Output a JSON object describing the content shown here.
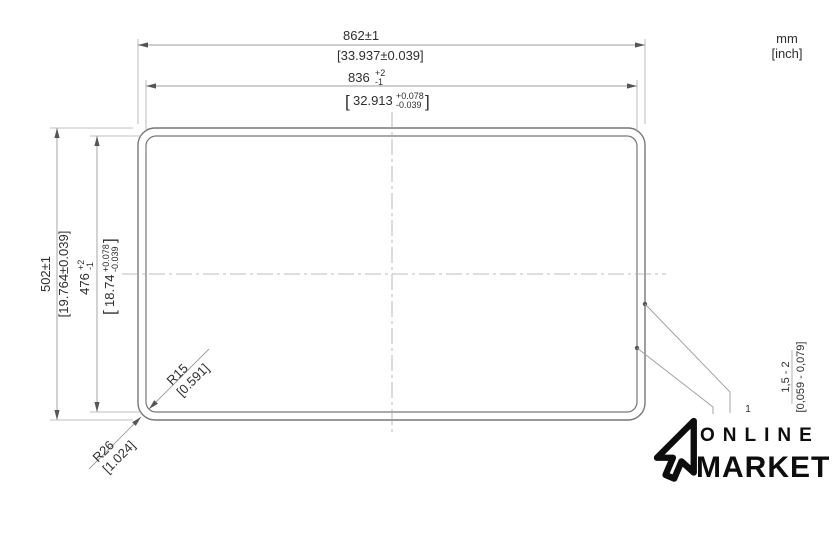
{
  "units": {
    "metric": "mm",
    "imperial": "[inch]"
  },
  "dims": {
    "width_outer": {
      "label": "862±1",
      "inch": "[33.937±0.039]"
    },
    "width_inner": {
      "value": "836",
      "tol_plus": "+2",
      "tol_minus": "-1",
      "inch_open": "[",
      "inch_value": "32.913",
      "inch_tol_plus": "+0.078",
      "inch_tol_minus": "-0.039",
      "inch_close": "]"
    },
    "height_outer": {
      "label": "502±1",
      "inch": "[19.764±0.039]"
    },
    "height_inner": {
      "value": "476",
      "tol_plus": "+2",
      "tol_minus": "-1",
      "inch_open": "[",
      "inch_value": "18.74",
      "inch_tol_plus": "+0.078",
      "inch_tol_minus": "-0.039",
      "inch_close": "]"
    },
    "radius_inner": {
      "label": "R15",
      "inch": "[0.591]"
    },
    "radius_outer": {
      "label": "R26",
      "inch": "[1.024]"
    },
    "thickness": {
      "ref": "1",
      "label": "1,5 - 2",
      "inch": "[0,059 - 0,079]"
    }
  },
  "logo": {
    "top": "ONLINE",
    "bottom": "MARKET"
  },
  "colors": {
    "edge_line": "#777777",
    "dim_line": "#9d9d9d",
    "center_line": "#a9a9a9",
    "text": "#2e2e2e",
    "logo": "#0d0d0d",
    "background": "#ffffff"
  }
}
